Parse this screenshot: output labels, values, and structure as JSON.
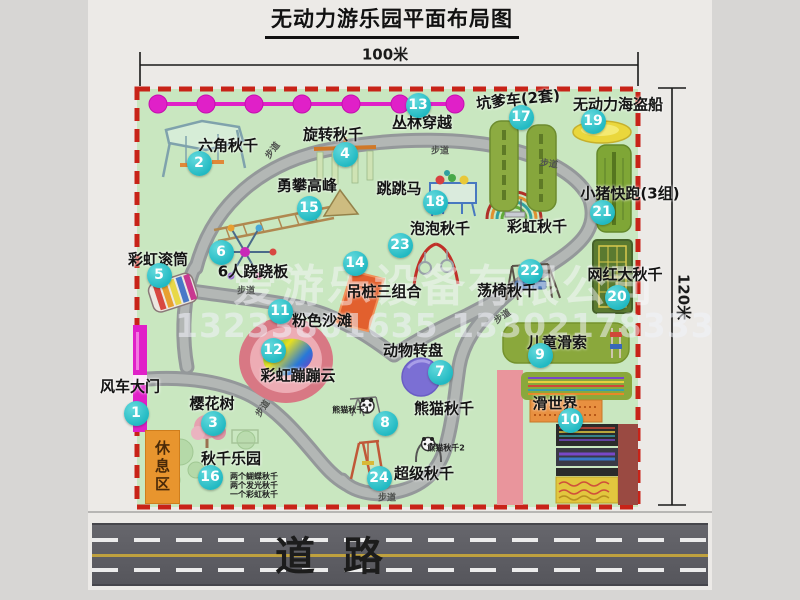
{
  "title": "无动力游乐园平面布局图",
  "dimensions": {
    "width": "100米",
    "height": "120米"
  },
  "watermark": {
    "company": "爱游乐设备有限公司",
    "phone": "13233861635 13302178333"
  },
  "road": {
    "char1": "道",
    "char2": "路"
  },
  "labels": {
    "trail": "步道",
    "rest_area": "休息区",
    "rainbow_swing": "彩虹秋千"
  },
  "attractions": [
    {
      "num": "1",
      "label": "风车大门"
    },
    {
      "num": "2",
      "label": "六角秋千"
    },
    {
      "num": "3",
      "label": "樱花树"
    },
    {
      "num": "4",
      "label": "旋转秋千"
    },
    {
      "num": "5",
      "label": "彩虹滚筒"
    },
    {
      "num": "6",
      "label": "6人跷跷板"
    },
    {
      "num": "7",
      "label": "动物转盘"
    },
    {
      "num": "8",
      "label": "熊猫秋千",
      "sub1": "熊猫秋千1",
      "sub2": "熊猫秋千2"
    },
    {
      "num": "9",
      "label": "儿童滑索"
    },
    {
      "num": "10",
      "label": "滑世界"
    },
    {
      "num": "11",
      "label": "粉色沙滩"
    },
    {
      "num": "12",
      "label": "彩虹蹦蹦云"
    },
    {
      "num": "13",
      "label": "丛林穿越"
    },
    {
      "num": "14",
      "label": "吊桩三组合"
    },
    {
      "num": "15",
      "label": "勇攀高峰"
    },
    {
      "num": "16",
      "label": "秋千乐园",
      "notes": [
        "两个蝴蝶秋千",
        "两个发光秋千",
        "一个彩虹秋千"
      ]
    },
    {
      "num": "17",
      "label": "坑爹车(2套)"
    },
    {
      "num": "18",
      "label": "跳跳马"
    },
    {
      "num": "19",
      "label": "无动力海盗船"
    },
    {
      "num": "20",
      "label": "网红大秋千"
    },
    {
      "num": "21",
      "label": "小猪快跑(3组)"
    },
    {
      "num": "22",
      "label": "荡椅秋千"
    },
    {
      "num": "23",
      "label": "泡泡秋千"
    },
    {
      "num": "24",
      "label": "超级秋千"
    }
  ]
}
